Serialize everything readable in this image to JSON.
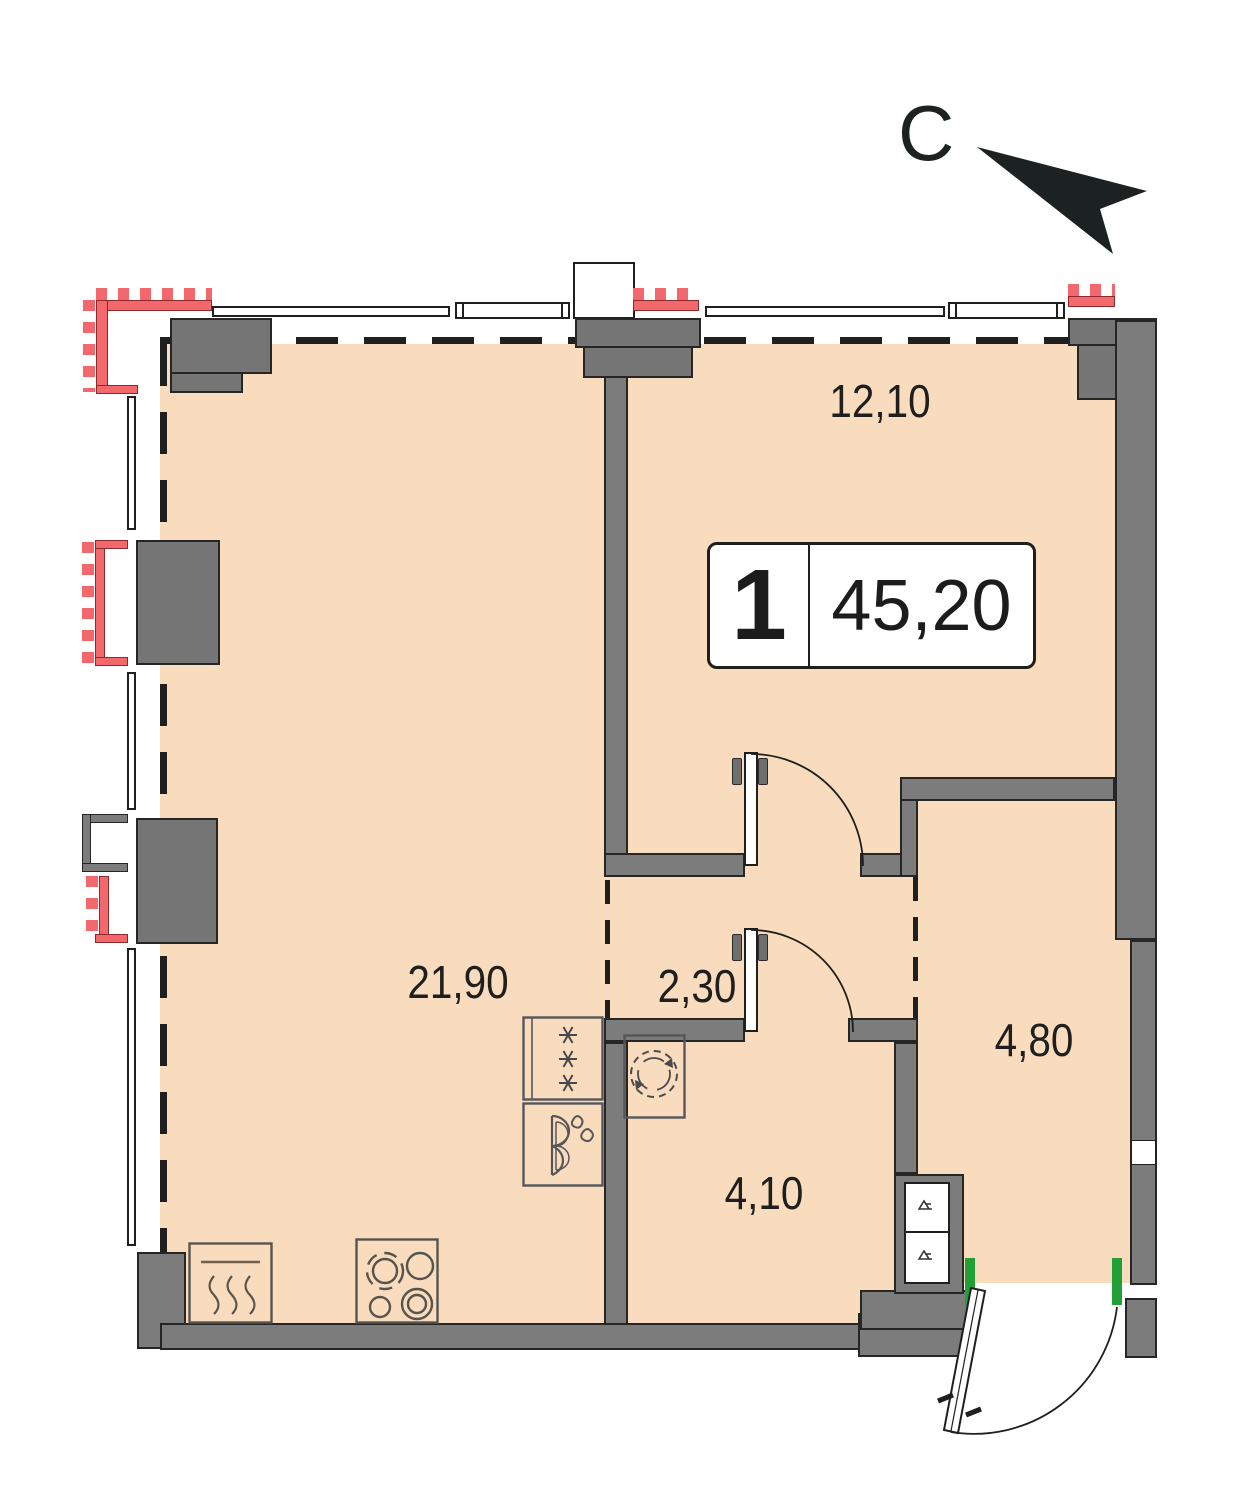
{
  "north": {
    "label": "С"
  },
  "badge": {
    "room_count": "1",
    "total_area": "45,20"
  },
  "rooms": [
    {
      "id": "bedroom",
      "area": "12,10"
    },
    {
      "id": "living-kitchen",
      "area": "21,90"
    },
    {
      "id": "hallway",
      "area": "2,30"
    },
    {
      "id": "side-room",
      "area": "4,80"
    },
    {
      "id": "bathroom",
      "area": "4,10"
    }
  ],
  "icons": [
    "north-arrow-icon",
    "fridge-icon",
    "sink-icon",
    "washing-machine-icon",
    "oven-icon",
    "stove-icon",
    "shaft-symbol-icon",
    "door-swing-arc"
  ],
  "colors": {
    "floor": "#f8dcbd",
    "wall": "#7c7c7c",
    "outline": "#262626",
    "window_hatch": "#f2686c",
    "threshold": "#21a038",
    "ink": "#1f1f1f"
  }
}
